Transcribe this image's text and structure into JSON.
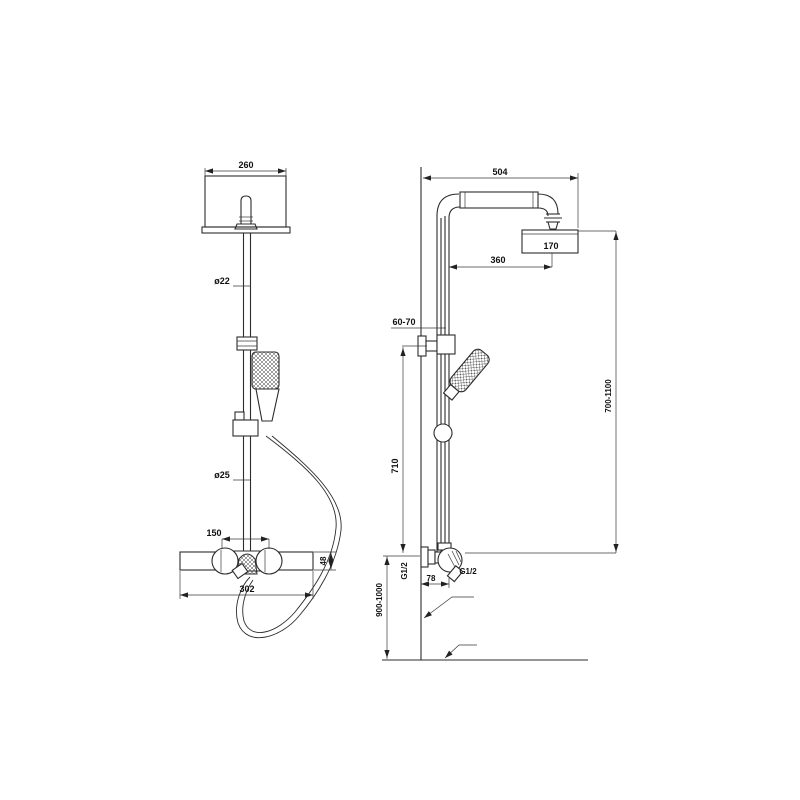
{
  "drawing": {
    "front_view": {
      "head_width": "260",
      "pipe_upper_dia": "ø22",
      "pipe_lower_dia": "ø25",
      "inlet_spacing": "150",
      "valve_body_width": "302",
      "valve_body_height": "48"
    },
    "side_view": {
      "reach_total": "504",
      "head_depth": "170",
      "head_offset": "360",
      "bracket_offset_range": "60-70",
      "slide_bar_length": "710",
      "head_height_range": "700-1100",
      "wall_inlet_thread": "G1/2",
      "outlet_thread": "G1/2",
      "outlet_offset": "78",
      "valve_mount_height_range": "900-1000"
    }
  }
}
